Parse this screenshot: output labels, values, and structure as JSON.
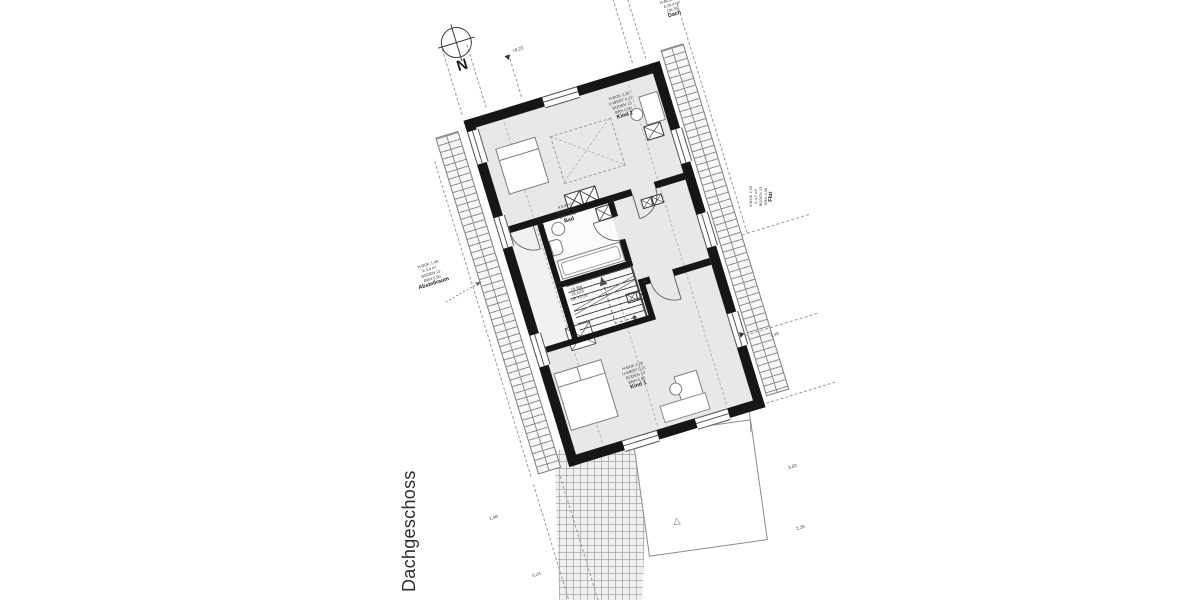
{
  "title": {
    "text": "Dachgeschoss"
  },
  "compass": {
    "label": "N"
  },
  "rooms": {
    "kind2": {
      "name": "Kind 2",
      "info": [
        "H-BOK 2,26",
        "U-WERT 0,21",
        "BODEN 13",
        "BRH 0,90"
      ]
    },
    "bad": {
      "name": "Bad",
      "info": [
        "A 5,6 m²",
        "BODEN 12",
        "BRH 1,36"
      ]
    },
    "kind1": {
      "name": "Kind 1",
      "info": [
        "H-BOK 2,26",
        "U-WERT 0,21",
        "BODEN 13",
        "BRH 0,90"
      ]
    },
    "abstell": {
      "name": "Abstellraum",
      "info": [
        "H-BOK 1,48",
        "A 3,4 m²",
        "BODEN 13",
        "BRH 0,90"
      ]
    },
    "flur": {
      "name": "Flur",
      "info": [
        "H-BOK 2,26",
        "A 4,7 m²",
        "BODEN 13",
        "BRH 0,90"
      ]
    },
    "dach": {
      "name": "Dach",
      "info": [
        "H-BOK 2,26",
        "A 28,4 m²",
        "DN 38°"
      ]
    }
  },
  "stairs": {
    "info": [
      "16 Stg",
      "18,4/25",
      "UK +2,26"
    ]
  },
  "marks": {
    "level_top": "+8,25",
    "right_1": "4,49",
    "right_2": "3,63",
    "right_3": "2,26",
    "bottom_1": "1,48",
    "bottom_2": "0,24",
    "triangle": "△"
  },
  "colors": {
    "wall": "#161616",
    "floor": "#e8e8e7",
    "line": "#9a9a9a",
    "text": "#3c3c3c"
  }
}
